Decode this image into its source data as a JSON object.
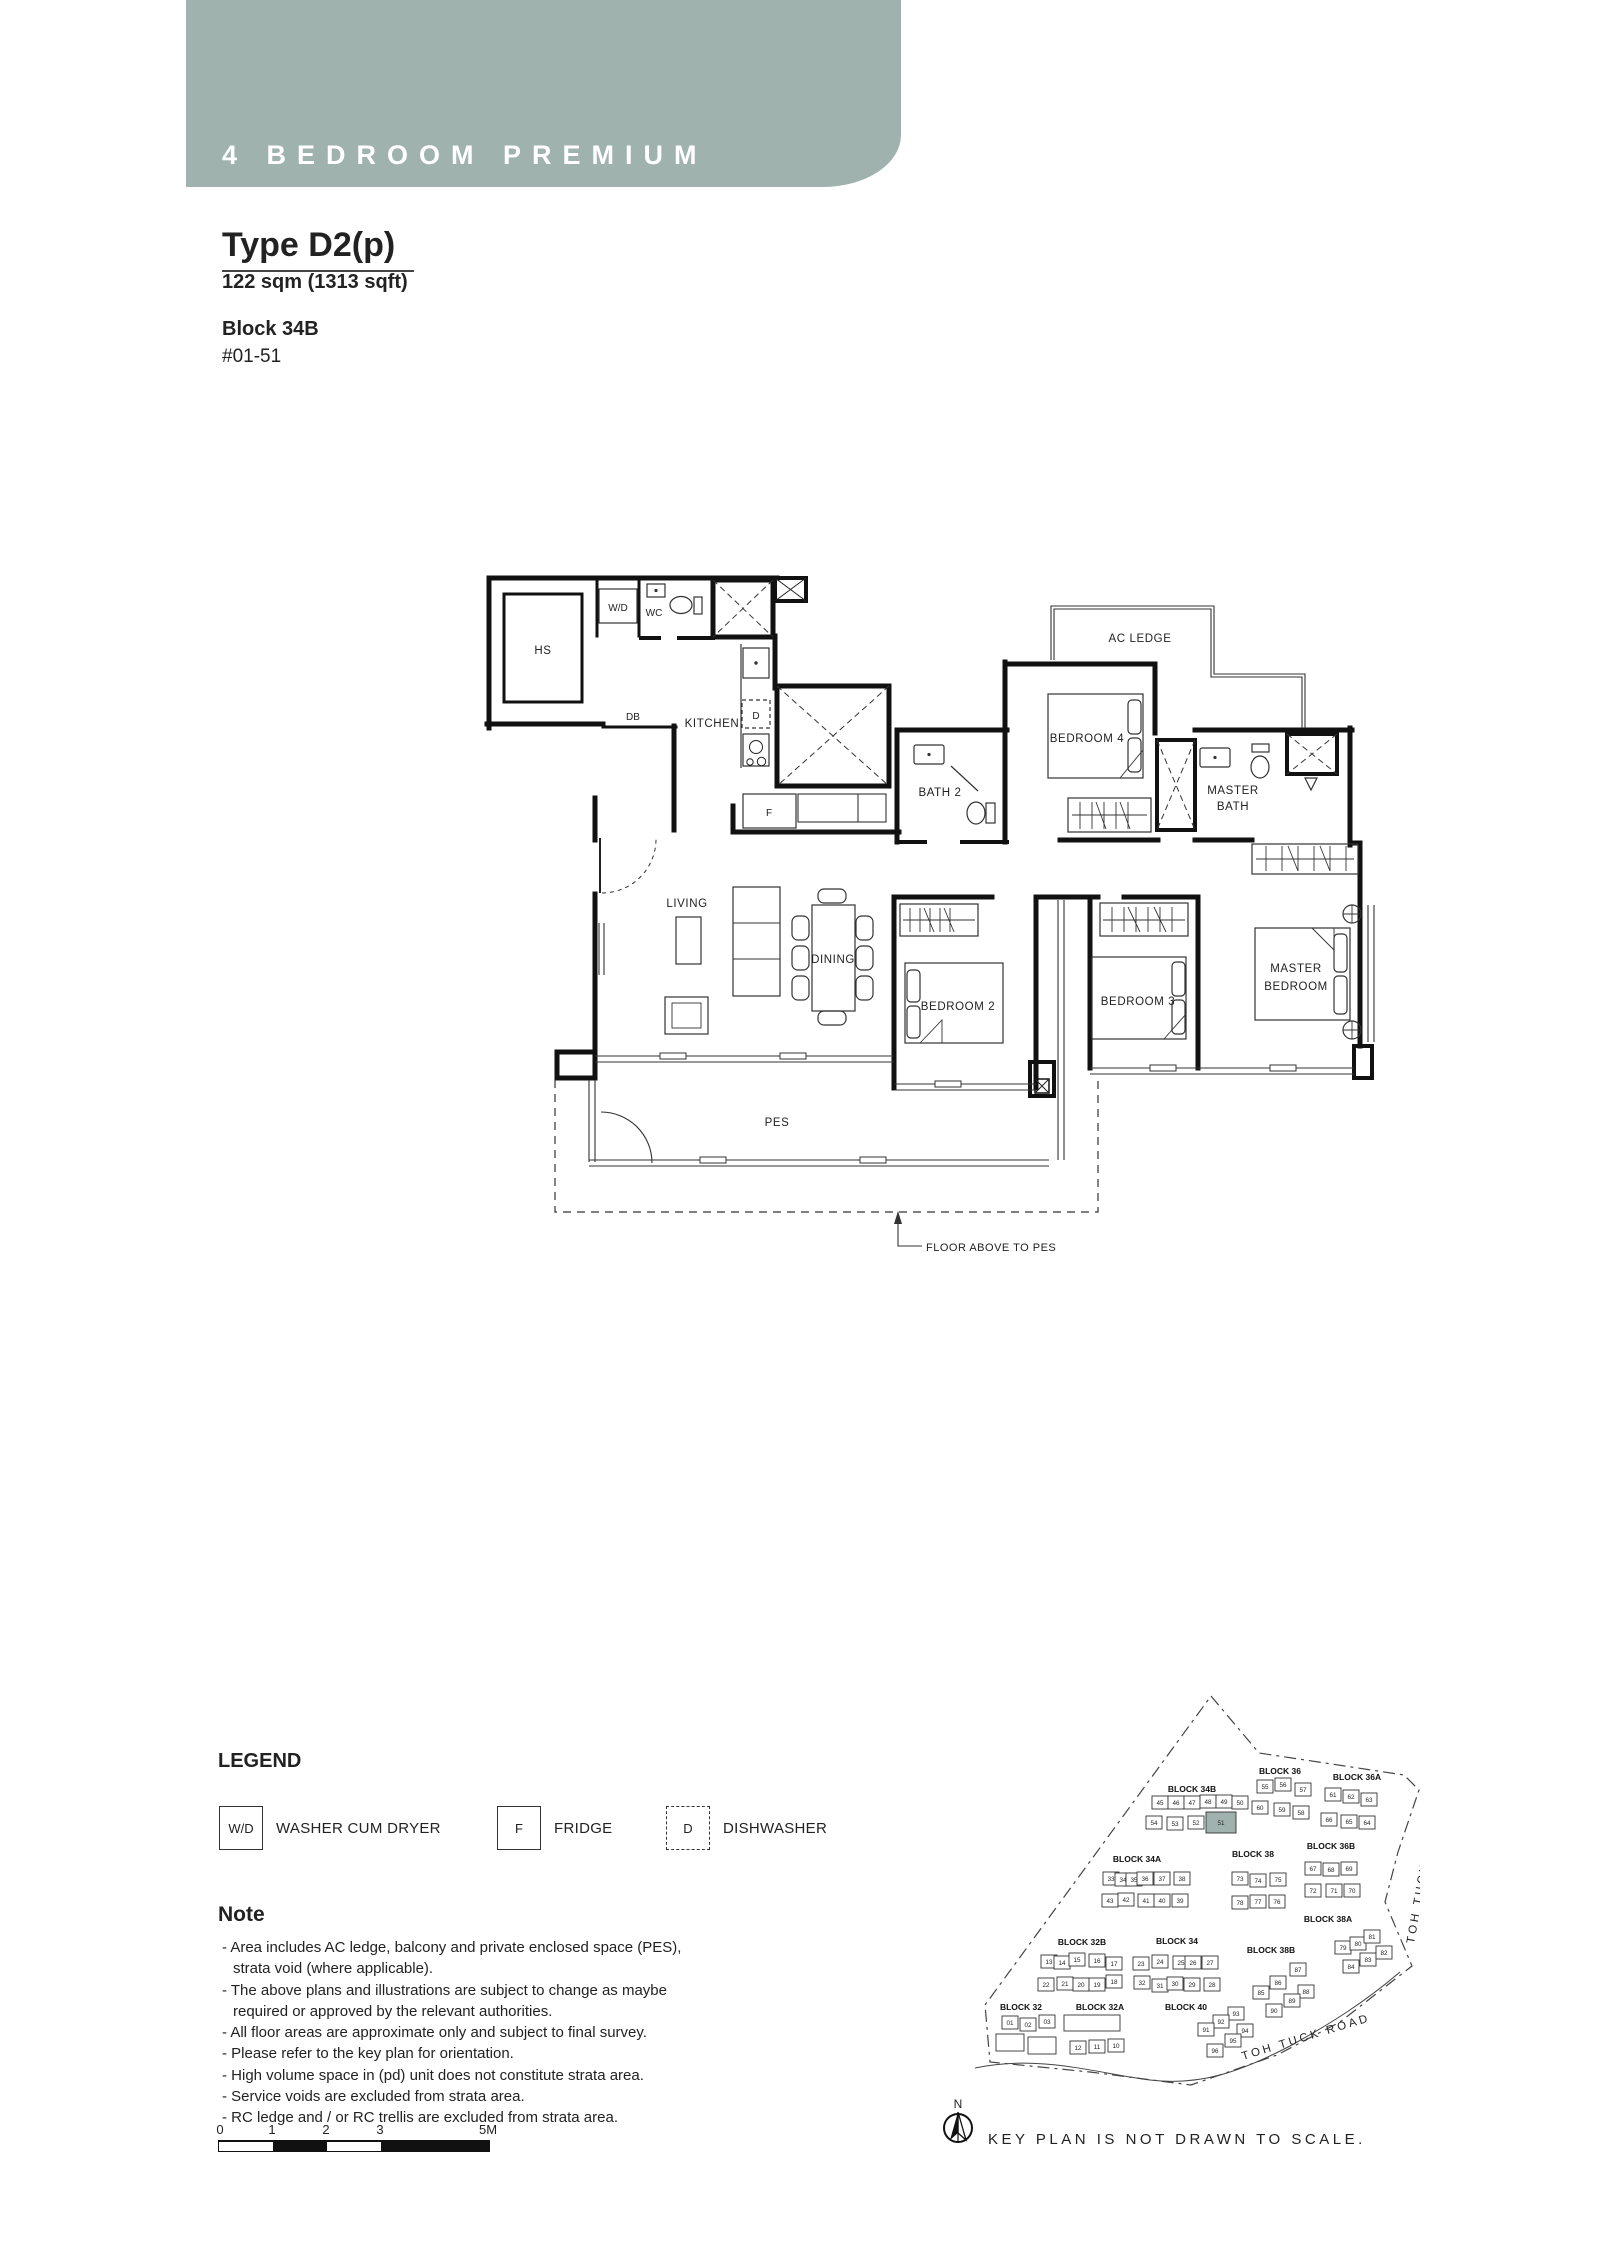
{
  "header": {
    "title": "4 BEDROOM PREMIUM",
    "accent_color": "#9fb2ae"
  },
  "unit": {
    "type": "Type D2(p)",
    "area": "122 sqm (1313 sqft)",
    "block": "Block 34B",
    "unit_no": "#01-51"
  },
  "floor_plan": {
    "labels": {
      "hs": "HS",
      "wd": "W/D",
      "wc": "WC",
      "db": "DB",
      "kitchen": "KITCHEN",
      "d": "D",
      "f": "F",
      "bath2": "BATH 2",
      "ac_ledge": "AC LEDGE",
      "bedroom4": "BEDROOM 4",
      "master_bath_1": "MASTER",
      "master_bath_2": "BATH",
      "living": "LIVING",
      "dining": "DINING",
      "bedroom2": "BEDROOM 2",
      "bedroom3": "BEDROOM 3",
      "master_bedroom_1": "MASTER",
      "master_bedroom_2": "BEDROOM",
      "pes": "PES",
      "floor_above": "FLOOR ABOVE TO PES"
    }
  },
  "legend": {
    "title": "LEGEND",
    "items": [
      {
        "symbol": "W/D",
        "label": "WASHER CUM DRYER",
        "style": "solid"
      },
      {
        "symbol": "F",
        "label": "FRIDGE",
        "style": "solid"
      },
      {
        "symbol": "D",
        "label": "DISHWASHER",
        "style": "dashed"
      }
    ]
  },
  "note": {
    "title": "Note",
    "lines": [
      "- Area includes AC ledge, balcony and private enclosed space (PES), strata void (where applicable).",
      "- The above plans and illustrations are subject to change as maybe required or approved by the relevant authorities.",
      "- All floor areas are approximate only and subject to final survey.",
      "- Please refer to the key plan for orientation.",
      "- High volume space in (pd) unit does not constitute strata area.",
      "- Service voids are excluded from strata area.",
      "- RC ledge and / or RC trellis are excluded from strata area."
    ]
  },
  "scale_bar": {
    "ticks": [
      "0",
      "1",
      "2",
      "3",
      "5M"
    ]
  },
  "key_plan": {
    "caption": "KEY PLAN IS NOT DRAWN TO SCALE.",
    "north_label": "N",
    "roads": [
      "TOH TUCK ROAD",
      "TOH TUCK ROAD"
    ],
    "highlight_unit": "51",
    "highlight_color": "#9fb2ae",
    "blocks": [
      {
        "label": "BLOCK 34B",
        "lx": 1192,
        "ly": 1792,
        "units": [
          {
            "n": "45",
            "x": 1152,
            "y": 1796
          },
          {
            "n": "46",
            "x": 1168,
            "y": 1796
          },
          {
            "n": "47",
            "x": 1184,
            "y": 1796
          },
          {
            "n": "48",
            "x": 1200,
            "y": 1795
          },
          {
            "n": "49",
            "x": 1216,
            "y": 1795
          },
          {
            "n": "50",
            "x": 1232,
            "y": 1796
          },
          {
            "n": "54",
            "x": 1146,
            "y": 1816
          },
          {
            "n": "53",
            "x": 1167,
            "y": 1817
          },
          {
            "n": "52",
            "x": 1188,
            "y": 1816
          },
          {
            "n": "51",
            "x": 1206,
            "y": 1812,
            "w": 30,
            "h": 21,
            "hl": true
          }
        ]
      },
      {
        "label": "BLOCK 36",
        "lx": 1280,
        "ly": 1774,
        "units": [
          {
            "n": "55",
            "x": 1257,
            "y": 1780
          },
          {
            "n": "56",
            "x": 1275,
            "y": 1778
          },
          {
            "n": "57",
            "x": 1295,
            "y": 1783
          },
          {
            "n": "60",
            "x": 1252,
            "y": 1801
          },
          {
            "n": "59",
            "x": 1274,
            "y": 1803
          },
          {
            "n": "58",
            "x": 1293,
            "y": 1806
          }
        ]
      },
      {
        "label": "BLOCK 36A",
        "lx": 1357,
        "ly": 1780,
        "units": [
          {
            "n": "61",
            "x": 1325,
            "y": 1788
          },
          {
            "n": "62",
            "x": 1343,
            "y": 1790
          },
          {
            "n": "63",
            "x": 1361,
            "y": 1793
          },
          {
            "n": "66",
            "x": 1321,
            "y": 1813
          },
          {
            "n": "65",
            "x": 1341,
            "y": 1815
          },
          {
            "n": "64",
            "x": 1359,
            "y": 1816
          }
        ]
      },
      {
        "label": "BLOCK 34A",
        "lx": 1137,
        "ly": 1862,
        "units": [
          {
            "n": "33",
            "x": 1103,
            "y": 1872
          },
          {
            "n": "34",
            "x": 1115,
            "y": 1873
          },
          {
            "n": "35",
            "x": 1126,
            "y": 1873
          },
          {
            "n": "36",
            "x": 1137,
            "y": 1872
          },
          {
            "n": "37",
            "x": 1154,
            "y": 1872
          },
          {
            "n": "38",
            "x": 1174,
            "y": 1872
          },
          {
            "n": "43",
            "x": 1102,
            "y": 1894
          },
          {
            "n": "42",
            "x": 1118,
            "y": 1893
          },
          {
            "n": "41",
            "x": 1138,
            "y": 1894
          },
          {
            "n": "40",
            "x": 1154,
            "y": 1894
          },
          {
            "n": "39",
            "x": 1172,
            "y": 1894
          }
        ]
      },
      {
        "label": "BLOCK 38",
        "lx": 1253,
        "ly": 1857,
        "units": [
          {
            "n": "73",
            "x": 1232,
            "y": 1872
          },
          {
            "n": "74",
            "x": 1250,
            "y": 1874
          },
          {
            "n": "75",
            "x": 1270,
            "y": 1873
          },
          {
            "n": "78",
            "x": 1232,
            "y": 1896
          },
          {
            "n": "77",
            "x": 1250,
            "y": 1895
          },
          {
            "n": "76",
            "x": 1269,
            "y": 1895
          }
        ]
      },
      {
        "label": "BLOCK 36B",
        "lx": 1331,
        "ly": 1849,
        "units": [
          {
            "n": "67",
            "x": 1305,
            "y": 1862
          },
          {
            "n": "68",
            "x": 1323,
            "y": 1863
          },
          {
            "n": "69",
            "x": 1341,
            "y": 1862
          },
          {
            "n": "72",
            "x": 1305,
            "y": 1884
          },
          {
            "n": "71",
            "x": 1326,
            "y": 1884
          },
          {
            "n": "70",
            "x": 1344,
            "y": 1884
          }
        ]
      },
      {
        "label": "BLOCK 32B",
        "lx": 1082,
        "ly": 1945,
        "units": [
          {
            "n": "13",
            "x": 1041,
            "y": 1955
          },
          {
            "n": "14",
            "x": 1054,
            "y": 1956
          },
          {
            "n": "15",
            "x": 1069,
            "y": 1953
          },
          {
            "n": "16",
            "x": 1089,
            "y": 1954
          },
          {
            "n": "17",
            "x": 1106,
            "y": 1957
          },
          {
            "n": "22",
            "x": 1038,
            "y": 1978
          },
          {
            "n": "21",
            "x": 1057,
            "y": 1977
          },
          {
            "n": "20",
            "x": 1073,
            "y": 1978
          },
          {
            "n": "19",
            "x": 1089,
            "y": 1978
          },
          {
            "n": "18",
            "x": 1106,
            "y": 1975
          }
        ]
      },
      {
        "label": "BLOCK 34",
        "lx": 1177,
        "ly": 1944,
        "units": [
          {
            "n": "23",
            "x": 1133,
            "y": 1957
          },
          {
            "n": "24",
            "x": 1152,
            "y": 1955
          },
          {
            "n": "25",
            "x": 1173,
            "y": 1956
          },
          {
            "n": "26",
            "x": 1185,
            "y": 1956
          },
          {
            "n": "27",
            "x": 1202,
            "y": 1956
          },
          {
            "n": "32",
            "x": 1134,
            "y": 1976
          },
          {
            "n": "31",
            "x": 1152,
            "y": 1979
          },
          {
            "n": "30",
            "x": 1167,
            "y": 1977
          },
          {
            "n": "29",
            "x": 1184,
            "y": 1978
          },
          {
            "n": "28",
            "x": 1204,
            "y": 1978
          }
        ]
      },
      {
        "label": "BLOCK 38B",
        "lx": 1271,
        "ly": 1953,
        "units": [
          {
            "n": "87",
            "x": 1290,
            "y": 1963
          },
          {
            "n": "86",
            "x": 1270,
            "y": 1976
          },
          {
            "n": "85",
            "x": 1253,
            "y": 1986
          },
          {
            "n": "88",
            "x": 1298,
            "y": 1985
          },
          {
            "n": "89",
            "x": 1284,
            "y": 1994
          },
          {
            "n": "90",
            "x": 1266,
            "y": 2004
          }
        ]
      },
      {
        "label": "BLOCK 38A",
        "lx": 1328,
        "ly": 1922,
        "units": [
          {
            "n": "79",
            "x": 1335,
            "y": 1941
          },
          {
            "n": "80",
            "x": 1350,
            "y": 1937
          },
          {
            "n": "81",
            "x": 1364,
            "y": 1930
          },
          {
            "n": "84",
            "x": 1343,
            "y": 1960
          },
          {
            "n": "83",
            "x": 1360,
            "y": 1953
          },
          {
            "n": "82",
            "x": 1376,
            "y": 1946
          }
        ]
      },
      {
        "label": "BLOCK 32",
        "lx": 1021,
        "ly": 2010,
        "blanks": [
          [
            996,
            2034,
            28,
            17
          ],
          [
            1028,
            2037,
            28,
            17
          ]
        ],
        "units": [
          {
            "n": "01",
            "x": 1002,
            "y": 2016
          },
          {
            "n": "02",
            "x": 1020,
            "y": 2018
          },
          {
            "n": "03",
            "x": 1039,
            "y": 2015
          }
        ]
      },
      {
        "label": "BLOCK 32A",
        "lx": 1100,
        "ly": 2010,
        "blanks": [
          [
            1064,
            2015,
            56,
            16
          ]
        ],
        "units": [
          {
            "n": "12",
            "x": 1070,
            "y": 2041
          },
          {
            "n": "11",
            "x": 1089,
            "y": 2040
          },
          {
            "n": "10",
            "x": 1108,
            "y": 2039
          }
        ]
      },
      {
        "label": "BLOCK 40",
        "lx": 1186,
        "ly": 2010,
        "units": [
          {
            "n": "93",
            "x": 1228,
            "y": 2007
          },
          {
            "n": "92",
            "x": 1213,
            "y": 2015
          },
          {
            "n": "91",
            "x": 1198,
            "y": 2023
          },
          {
            "n": "94",
            "x": 1237,
            "y": 2024
          },
          {
            "n": "95",
            "x": 1225,
            "y": 2034
          },
          {
            "n": "96",
            "x": 1207,
            "y": 2044
          }
        ]
      }
    ]
  }
}
